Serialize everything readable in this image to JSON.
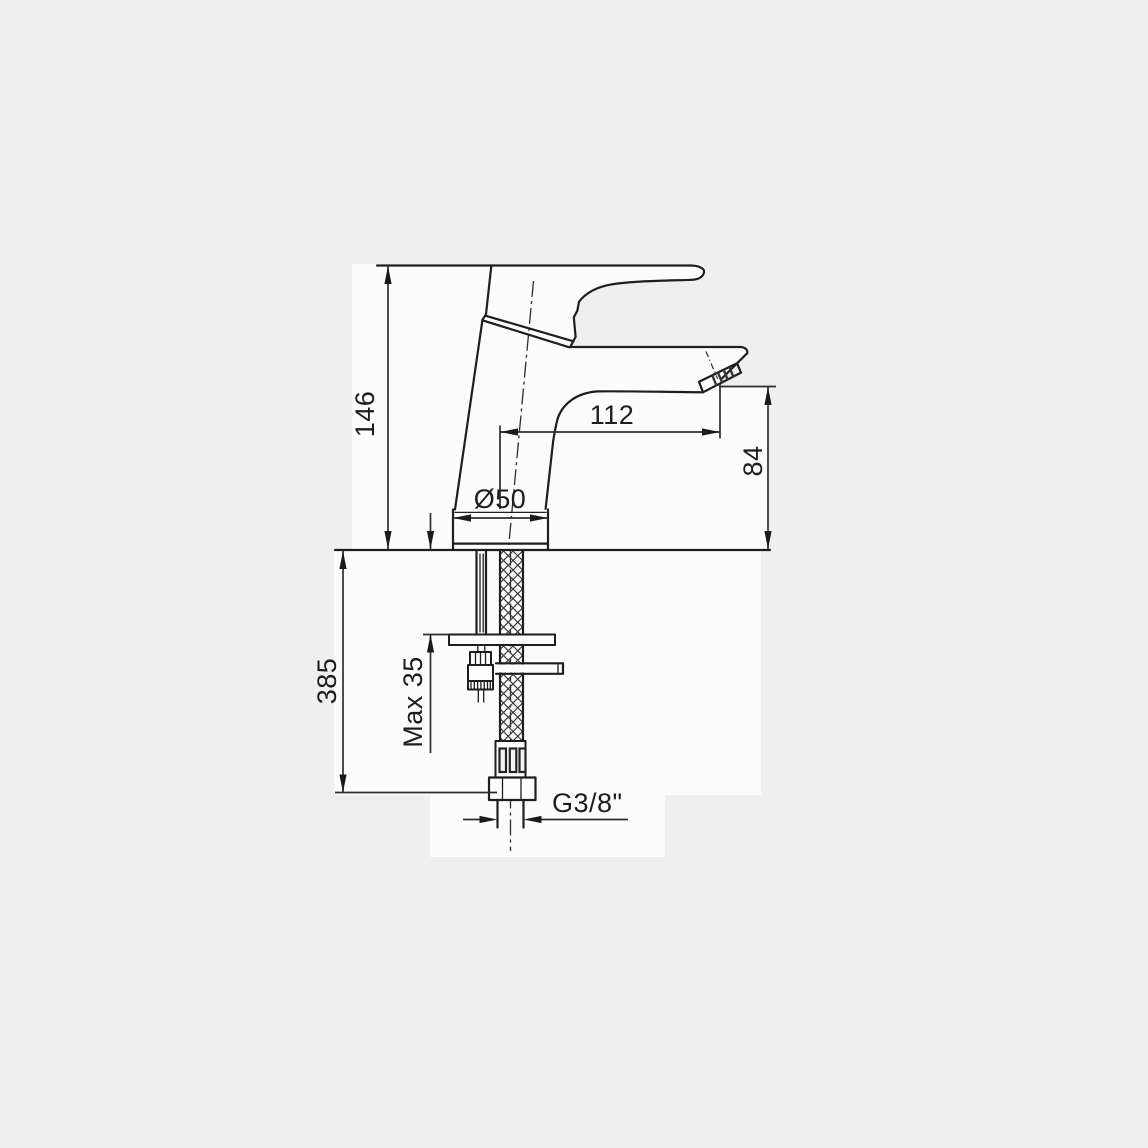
{
  "colors": {
    "page_bg": "#efefef",
    "canvas_white": "#fcfcfc",
    "outline": "#1e1e1e",
    "dimension": "#2e2e2e",
    "arrow": "#1a1a1a",
    "text": "#1d1d1b"
  },
  "drawing": {
    "type": "technical-dimension-drawing",
    "subject": "single-lever basin mixer faucet, side elevation with installation dimensions"
  },
  "labels": {
    "height": "146",
    "reach": "112",
    "spout_height": "84",
    "base_diameter": "Ø50",
    "below_deck": "385",
    "max_thickness": "Max 35",
    "thread": "G3/8\""
  }
}
